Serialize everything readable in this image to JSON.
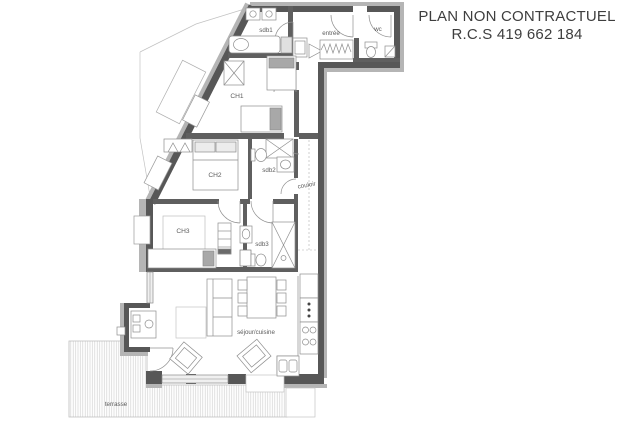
{
  "header": {
    "title_line1": "PLAN NON CONTRACTUEL",
    "title_line2": "R.C.S 419 662 184"
  },
  "plan": {
    "rooms": [
      {
        "id": "sdb1",
        "label": "sdb1"
      },
      {
        "id": "entree",
        "label": "entrée"
      },
      {
        "id": "wc",
        "label": "wc"
      },
      {
        "id": "ch1",
        "label": "CH1"
      },
      {
        "id": "ch2",
        "label": "CH2"
      },
      {
        "id": "sdb2",
        "label": "sdb2"
      },
      {
        "id": "couloir",
        "label": "couloir"
      },
      {
        "id": "ch3",
        "label": "CH3"
      },
      {
        "id": "sdb3",
        "label": "sdb3"
      },
      {
        "id": "sejour",
        "label": "séjour/cuisine"
      },
      {
        "id": "terrasse",
        "label": "terrasse"
      }
    ],
    "colors": {
      "wall_dark": "#575757",
      "wall_interior": "#5f5f5f",
      "wall_light_band": "#b5b5b5",
      "furniture_line": "#8e8e8e",
      "hatch": "#d2d2d2",
      "label_text": "#5c5c5c",
      "title_text": "#3e3e3e"
    }
  }
}
